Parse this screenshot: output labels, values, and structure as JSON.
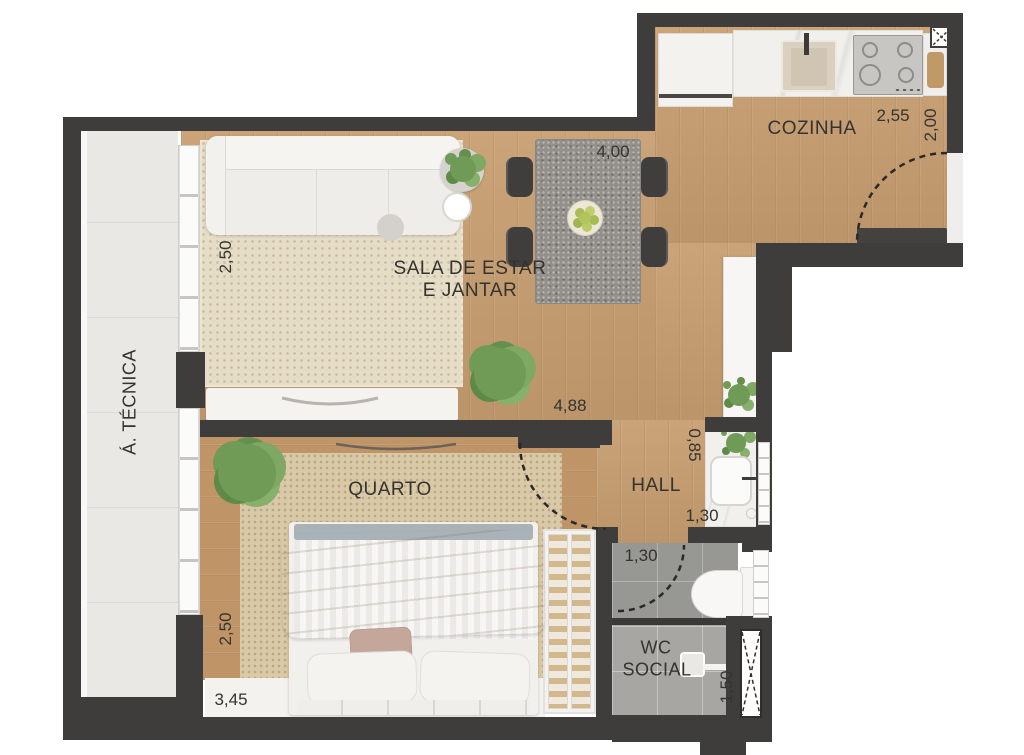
{
  "rooms": {
    "kitchen": "COZINHA",
    "living_line1": "SALA DE ESTAR",
    "living_line2": "E JANTAR",
    "bedroom": "QUARTO",
    "hall": "HALL",
    "wc_line1": "WC",
    "wc_line2": "SOCIAL",
    "technical_area": "Á. TÉCNICA"
  },
  "dimensions": {
    "kitchen_width": "2,55",
    "kitchen_depth": "2,00",
    "dining_width": "4,00",
    "living_depth": "2,50",
    "living_total_width": "4,88",
    "basin_niche_depth": "0,85",
    "basin_niche_width": "1,30",
    "wc_door_width": "1,30",
    "bedroom_depth": "2,50",
    "bedroom_width": "3,45",
    "wc_depth": "1,50"
  },
  "colors": {
    "wall": "#3e3d3b",
    "wood_floor": "#c79e70",
    "living_rug": "#e6ddc7",
    "bedroom_rug": "#d9c9a7",
    "bathroom_tile": "#a7a6a3",
    "technical_tile": "#eae8e5",
    "blanket": "#c1a197",
    "plant_green": "#6f9b57"
  }
}
